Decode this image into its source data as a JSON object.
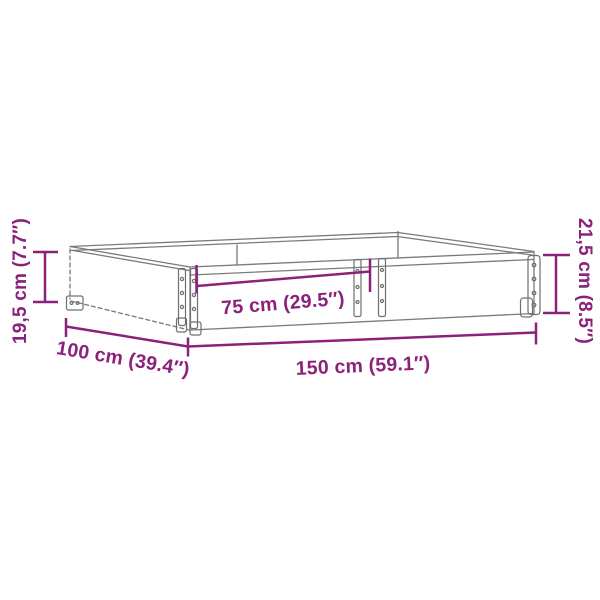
{
  "figure": {
    "type": "product-dimension-diagram",
    "subject": "pallet-collar-frame",
    "background_color": "#ffffff",
    "accent_color": "#8C2179",
    "line_color": "#7a7a7a",
    "hinge_color": "#6f6f6f"
  },
  "dimensions": {
    "height_left": "19,5 cm (7.7″)",
    "height_right": "21,5 cm (8.5″)",
    "half_length": "75 cm (29.5″)",
    "depth": "100 cm (39.4″)",
    "length": "150 cm (59.1″)"
  }
}
